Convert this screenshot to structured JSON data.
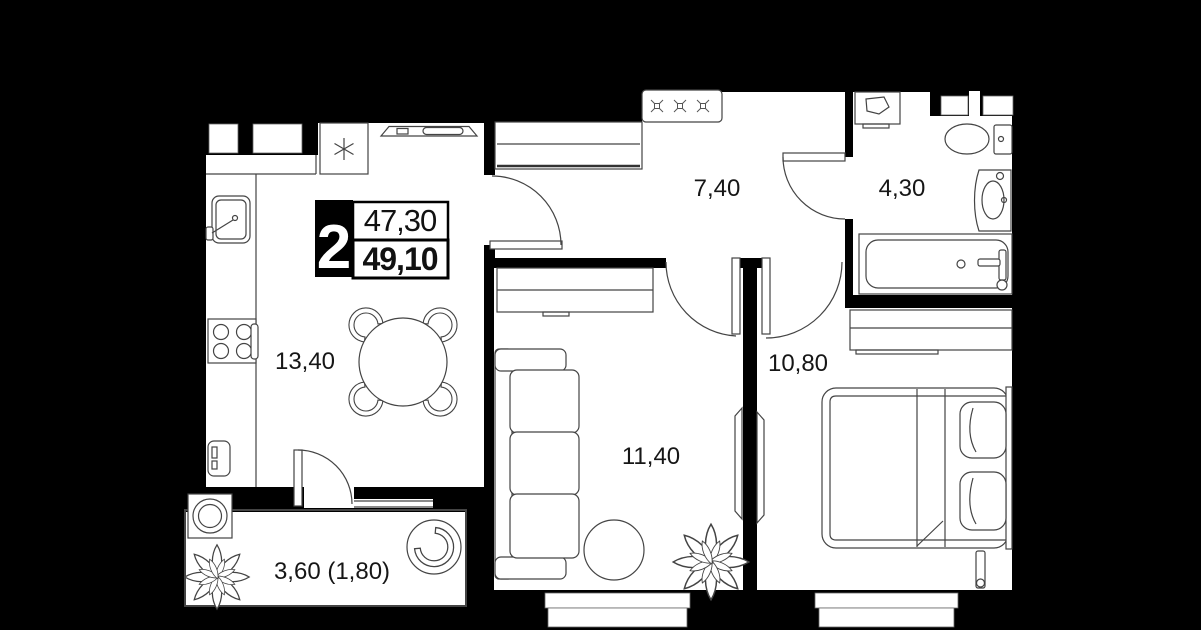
{
  "plan": {
    "badge": {
      "rooms_count": "2",
      "area_top": "47,30",
      "area_bottom": "49,10"
    },
    "rooms": [
      {
        "name": "kitchen-dining",
        "area": "13,40"
      },
      {
        "name": "hallway",
        "area": "7,40"
      },
      {
        "name": "bathroom",
        "area": "4,30"
      },
      {
        "name": "bedroom",
        "area": "10,80"
      },
      {
        "name": "living-room",
        "area": "11,40"
      },
      {
        "name": "balcony",
        "area": "3,60 (1,80)"
      }
    ],
    "colors": {
      "background": "#000000",
      "floor": "#ffffff",
      "walls": "#000000",
      "linework": "#444444"
    }
  }
}
